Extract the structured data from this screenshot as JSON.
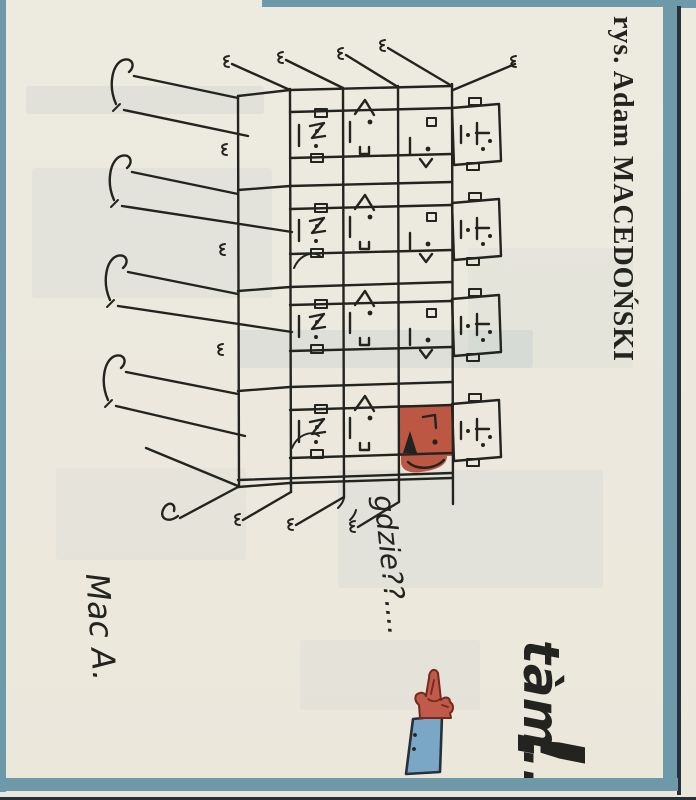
{
  "credit": "rys. Adam MACEDOŃSKI",
  "speech": {
    "where": "gdzie??....",
    "there": "tàm..",
    "there_mark": "!"
  },
  "signature": "Mac A.",
  "building": {
    "floors": 4,
    "window_columns": 4,
    "red_window": {
      "floor_from_top": 4,
      "column_from_left": 3
    }
  },
  "colors": {
    "paper": "#edeae0",
    "ink": "#23241f",
    "teal": "#6d99a8",
    "navy": "#27313c",
    "red": "#bc5743",
    "hand": "#c05a4a",
    "hand-outline": "#74291e",
    "sleeve": "#7ba7c6",
    "ghost": "#8fa8b8"
  }
}
